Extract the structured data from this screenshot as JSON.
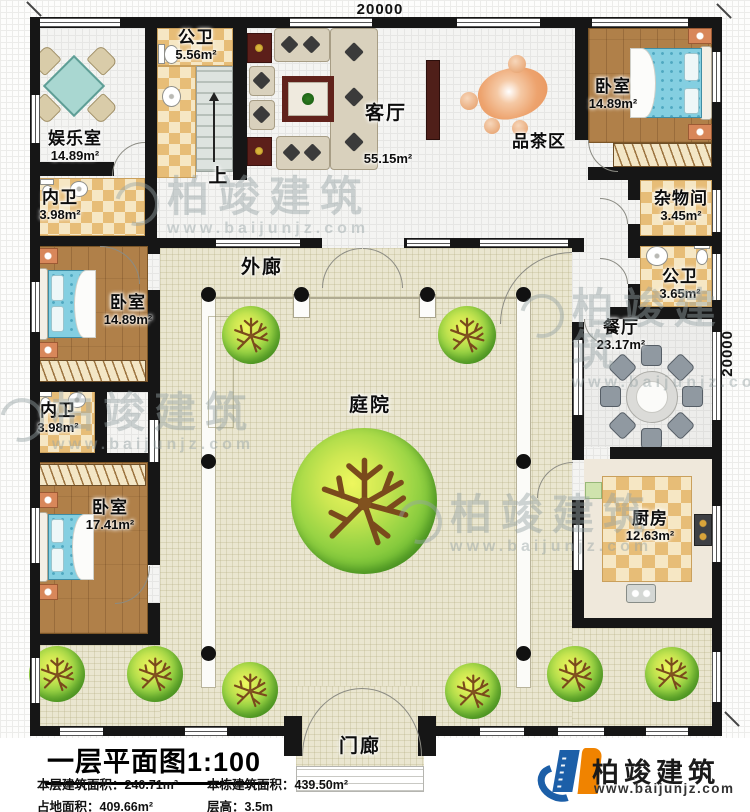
{
  "dimensions": {
    "top": "20000",
    "right": "20000"
  },
  "rooms": {
    "entertainment": {
      "name": "娱乐室",
      "area": "14.89m²"
    },
    "public_bath_north": {
      "name": "公卫",
      "area": "5.56m²"
    },
    "living_room": {
      "name": "客厅",
      "area": "55.15m²"
    },
    "tea_area": {
      "name": "品茶区"
    },
    "bedroom_northeast": {
      "name": "卧室",
      "area": "14.89m²"
    },
    "storage_room": {
      "name": "杂物间",
      "area": "3.45m²"
    },
    "public_bath_east": {
      "name": "公卫",
      "area": "3.65m²"
    },
    "dining_room": {
      "name": "餐厅",
      "area": "23.17m²"
    },
    "inner_bath_north": {
      "name": "内卫",
      "area": "3.98m²"
    },
    "bedroom_west": {
      "name": "卧室",
      "area": "14.89m²"
    },
    "inner_bath_south": {
      "name": "内卫",
      "area": "3.98m²"
    },
    "bedroom_southwest": {
      "name": "卧室",
      "area": "17.41m²"
    },
    "kitchen": {
      "name": "厨房",
      "area": "12.63m²"
    },
    "veranda": {
      "name": "外廊"
    },
    "courtyard": {
      "name": "庭院"
    },
    "porch": {
      "name": "门廊"
    },
    "stairs": {
      "up_label": "上"
    }
  },
  "title_block": {
    "title": "一层平面图1:100",
    "stats": [
      {
        "label": "本层建筑面积：",
        "value": "240.71m²"
      },
      {
        "label": "本栋建筑面积：",
        "value": "439.50m²"
      },
      {
        "label": "占地面积：",
        "value": "409.66m²"
      },
      {
        "label": "层高：",
        "value": "3.5m"
      }
    ]
  },
  "brand": {
    "name": "柏竣建筑",
    "url": "www.baijunjz.com",
    "blue": "#1c5fa8",
    "orange": "#f08300"
  },
  "watermark": {
    "name": "柏竣建筑",
    "url": "www.baijunjz.com"
  }
}
